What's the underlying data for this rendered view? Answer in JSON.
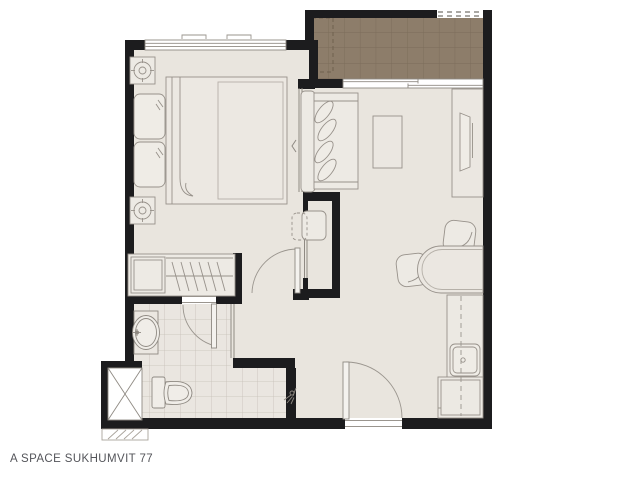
{
  "plan": {
    "title": "A SPACE SUKHUMVIT 77",
    "colors": {
      "background": "#ffffff",
      "wall": "#1c1c1e",
      "floor": "#e9e5de",
      "furniture_fill": "#edeae4",
      "balcony_tile": "#8d7d6a",
      "balcony_grid": "#7b6c5a",
      "bath_tile_grid": "#c6c0b7",
      "line": "#97918a",
      "title_text": "#54555a"
    }
  }
}
